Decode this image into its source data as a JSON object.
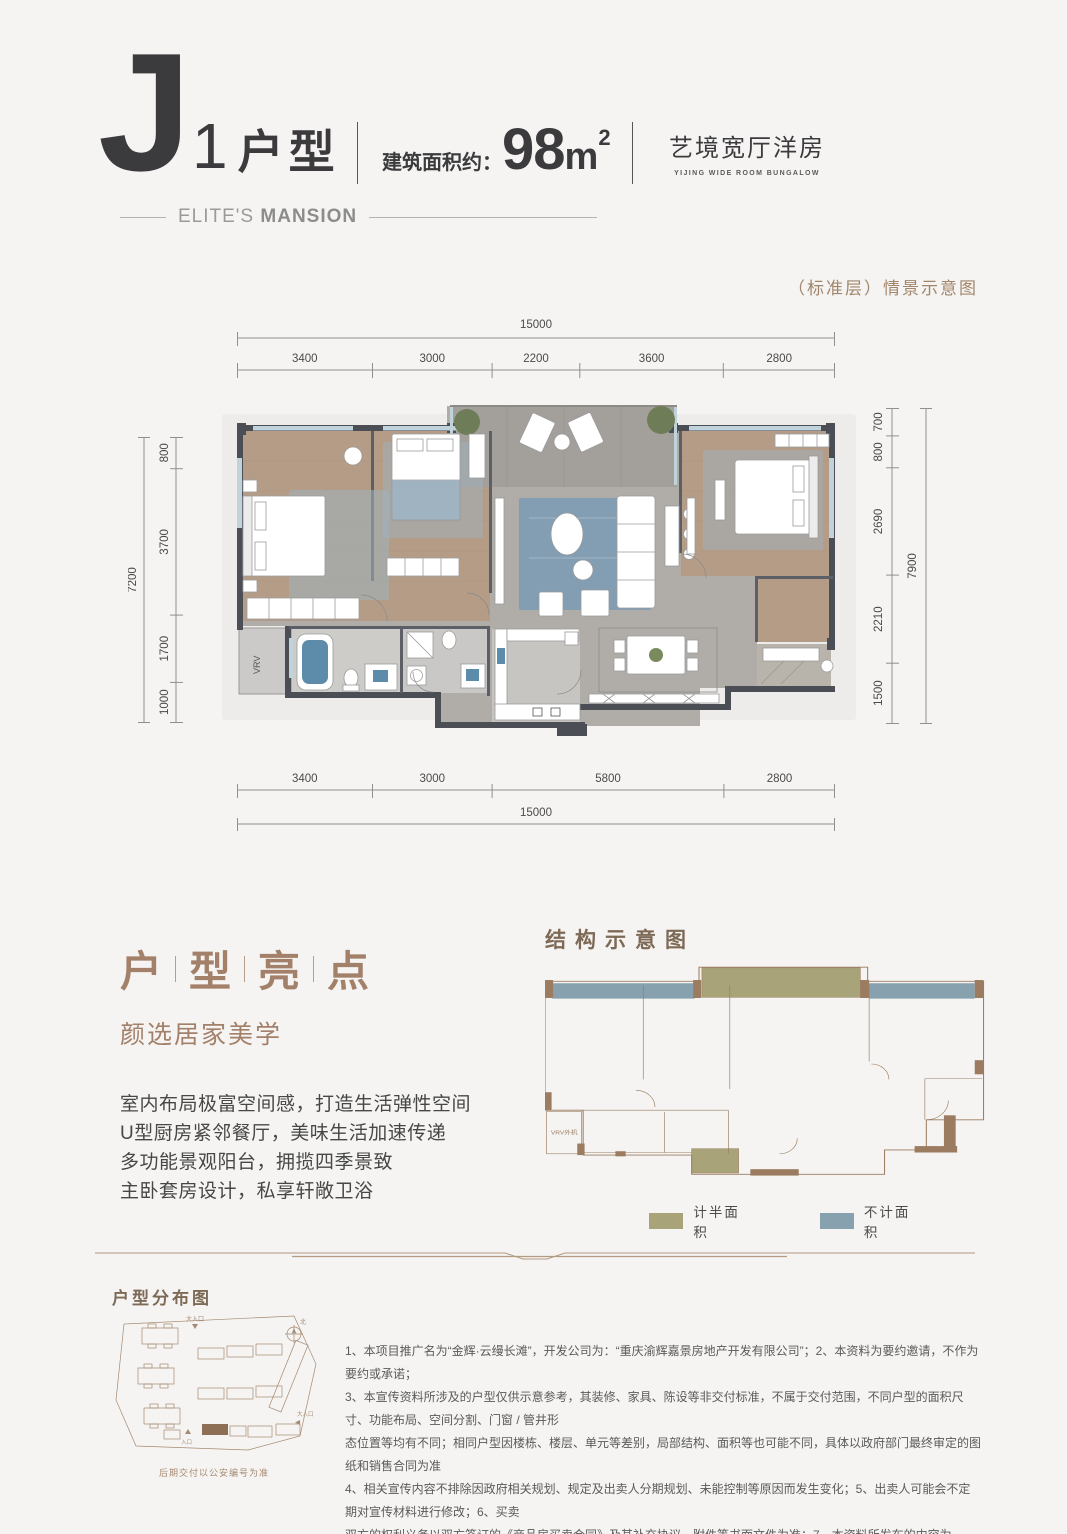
{
  "header": {
    "type_letter": "J",
    "type_number": "1",
    "type_suffix": "户型",
    "area_label": "建筑面积约：",
    "area_value": "98",
    "area_unit": "m",
    "area_exp": "2",
    "slogan_cn": "艺境宽厅洋房",
    "slogan_en": "YIJING WIDE ROOM BUNGALOW",
    "brand_light": "ELITE'S",
    "brand_bold": "MANSION"
  },
  "plan": {
    "caption": "（标准层）情景示意图",
    "vrv_label": "VRV",
    "dims": {
      "top_total": "15000",
      "top": [
        "3400",
        "3000",
        "2200",
        "3600",
        "2800"
      ],
      "bottom": [
        "3400",
        "3000",
        "5800",
        "2800"
      ],
      "bottom_total": "15000",
      "left_total": "7200",
      "left": [
        "800",
        "3700",
        "1700",
        "1000"
      ],
      "right": [
        "700",
        "800",
        "2690",
        "2210",
        "1500"
      ],
      "right_total": "7900"
    }
  },
  "highlights": {
    "title_chars": [
      "户",
      "型",
      "亮",
      "点"
    ],
    "subtitle": "颜选居家美学",
    "items": [
      "室内布局极富空间感，打造生活弹性空间",
      "U型厨房紧邻餐厅，美味生活加速传递",
      "多功能景观阳台，拥揽四季景致",
      "主卧套房设计，私享轩敞卫浴"
    ]
  },
  "structure": {
    "title": "结构示意图",
    "vrv_label": "VRV外机",
    "legend": [
      {
        "label": "计半面积",
        "color": "#a9a379"
      },
      {
        "label": "不计面积",
        "color": "#87a2ae"
      }
    ]
  },
  "distribution": {
    "title": "户型分布图",
    "north_label": "北",
    "entrance_top": "大入口",
    "entrance_right": "大入口",
    "entrance_bottom": "入口",
    "caption": "后期交付以公安编号为准"
  },
  "disclaimer": {
    "lines": [
      "1、本项目推广名为“金辉·云缦长滩”，开发公司为：“重庆渝辉嘉景房地产开发有限公司”；2、本资料为要约邀请，不作为要约或承诺；",
      "3、本宣传资料所涉及的户型仅供示意参考，其装修、家具、陈设等非交付标准，不属于交付范围，不同户型的面积尺寸、功能布局、空间分割、门窗 / 管井形",
      "态位置等均有不同；相同户型因楼栋、楼层、单元等差别，局部结构、面积等也可能不同，具体以政府部门最终审定的图纸和销售合同为准",
      "4、相关宣传内容不排除因政府相关规划、规定及出卖人分期规划、未能控制等原因而发生变化；5、出卖人可能会不定期对宣传材料进行修改；6、买卖",
      "双方的权利义务以双方签订的《商品房买卖合同》及其补充协议、附件等书面文件为准；7、本资料所发布的内容为 2021 年 9 月 30 日前的信息，敬请留意最新资料。"
    ]
  },
  "colors": {
    "accent_brown": "#a1866b",
    "title_brown": "#a28069",
    "dark_text": "#3b3b3d",
    "wall": "#4b4e55",
    "wood_floor": "#b49c86",
    "marble_floor": "#b0ada8",
    "window_blue": "#c0d3da",
    "rug_blue": "#7e9cb3",
    "water_blue": "#5d8cab",
    "legend_olive": "#a9a379",
    "legend_blue": "#87a2ae",
    "outline_brown": "#9b7c60"
  }
}
